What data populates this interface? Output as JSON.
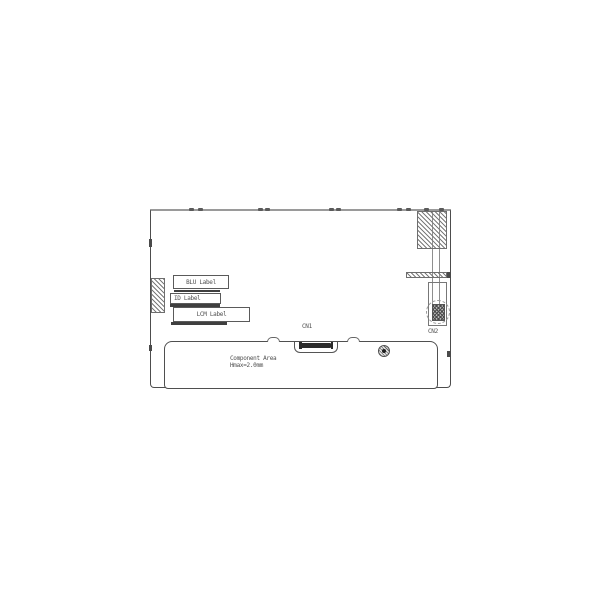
{
  "labels": {
    "blu_label": "BLU Label",
    "id_label": "ID Label",
    "lcm_label": "LCM Label",
    "cn1": "CN1",
    "cn2": "CN2",
    "component_area": "Component Area",
    "component_height": "Hmax=2.0mm"
  },
  "colors": {
    "line": "#4d4d4d",
    "top_edge": "#9a9a9a",
    "hatch": "#7a7a7a",
    "text": "#4f4f4f",
    "background": "#ffffff"
  }
}
